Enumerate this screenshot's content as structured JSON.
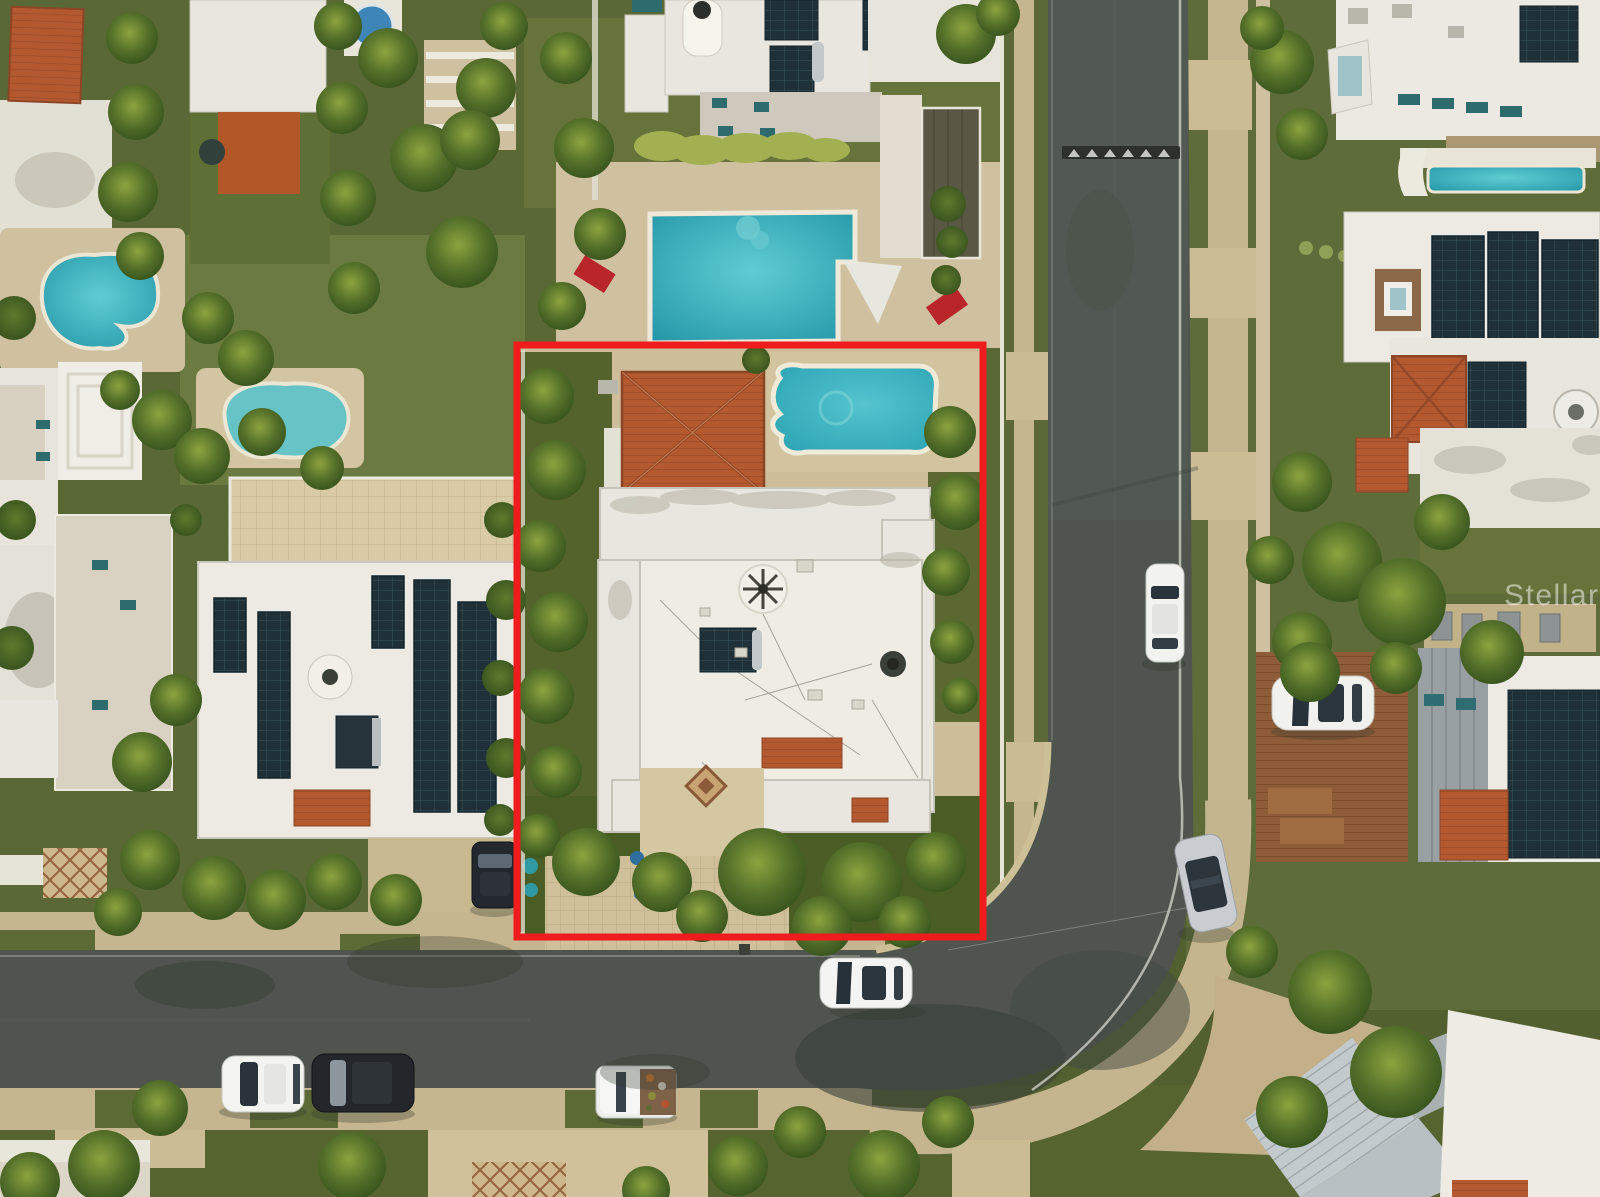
{
  "watermark": {
    "text": "Stellar MLS"
  },
  "scene": {
    "type": "aerial-drone-photo",
    "subject": "residential lot highlighted with red boundary outline",
    "neighborhood": "tropical residential block with white flat-roof houses, palm trees, pools and solar panels",
    "highlighted_lot": {
      "features": [
        "terracotta hip roof",
        "freeform swimming pool",
        "white flat roof with rooftop equipment",
        "solar water heater",
        "paver driveway",
        "palm landscaping"
      ]
    },
    "streets": [
      "vertical street on right",
      "horizontal street at bottom",
      "curved intersection",
      "speed bump near top of vertical street"
    ],
    "pool_count": 5,
    "vehicles": [
      {
        "color": "white",
        "location": "driving on bottom street"
      },
      {
        "color": "white",
        "location": "parked along right street"
      },
      {
        "color": "silver",
        "location": "parked at the curve"
      },
      {
        "color": "white",
        "location": "parked on wooden deck driveway"
      },
      {
        "color": "white",
        "location": "SUV parked on bottom street"
      },
      {
        "color": "black",
        "location": "SUV parked on bottom street"
      },
      {
        "color": "white",
        "location": "pickup truck with cargo on bottom street"
      },
      {
        "color": "black",
        "location": "SUV on left-side driveway"
      }
    ],
    "rooftop_items": [
      "solar panel arrays",
      "water tanks",
      "AC units",
      "vent fan",
      "shade sail",
      "red lounge chairs"
    ],
    "palette": {
      "boundary_red": "#ee1c1c",
      "asphalt": "#4f554e",
      "sidewalk_tan": "#c6b690",
      "grass_green": "#5d6b38",
      "tree_canopy": "#4a6a2c",
      "roof_white": "#eae7e0",
      "roof_terracotta": "#b35a30",
      "pool_teal": "#3aacb9",
      "solar_panel": "#223039",
      "lounge_chair_red": "#b8262c",
      "wood_deck": "#8a5a38"
    }
  }
}
